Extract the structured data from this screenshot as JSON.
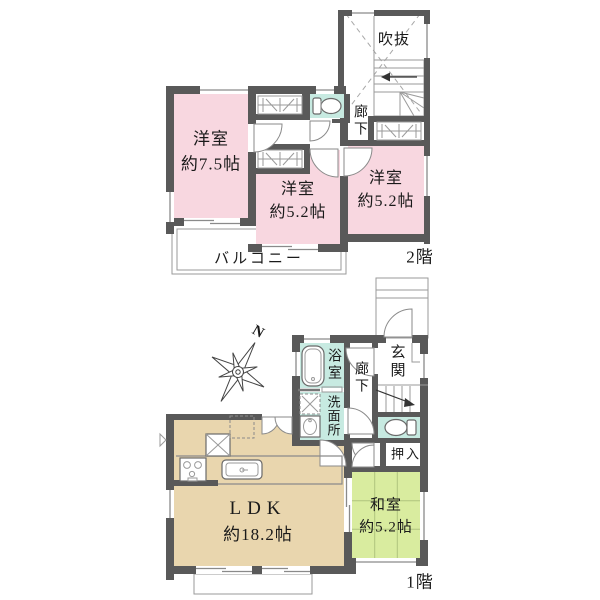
{
  "colors": {
    "wall": "#595959",
    "room_pink": "#f8d7e0",
    "wet_cyan": "#c7eae1",
    "ldk_tan": "#e9d6ae",
    "tatami_green": "#d9ec9f"
  },
  "floor2": {
    "floor_label": "2階",
    "void": "吹抜",
    "corridor": "廊下",
    "western_room_1": {
      "name": "洋室",
      "size": "約7.5帖"
    },
    "western_room_2": {
      "name": "洋室",
      "size": "約5.2帖"
    },
    "western_room_3": {
      "name": "洋室",
      "size": "約5.2帖"
    },
    "balcony": "バルコニー"
  },
  "floor1": {
    "floor_label": "1階",
    "bath": "浴室",
    "washroom": "洗面所",
    "corridor": "廊下",
    "entrance": "玄関",
    "closet": "押入",
    "ldk": {
      "name": "LDK",
      "size": "約18.2帖"
    },
    "japanese_room": {
      "name": "和室",
      "size": "約5.2帖"
    }
  },
  "compass": {
    "north": "N"
  }
}
